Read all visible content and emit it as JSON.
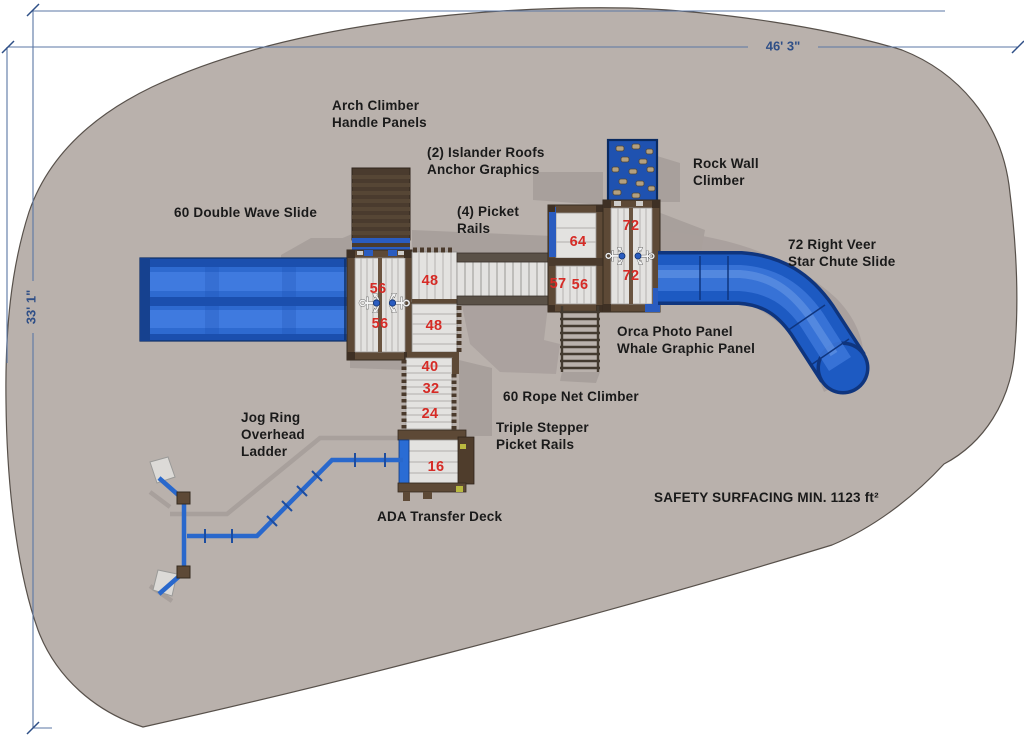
{
  "drawing": {
    "title_area": "playground plan view",
    "dimensions": {
      "width_label": "46' 3\"",
      "height_label": "33' 1\""
    },
    "labels": {
      "arch_climber": "Arch Climber\nHandle Panels",
      "islander_roofs": "(2) Islander Roofs\nAnchor Graphics",
      "picket_rails": "(4) Picket\nRails",
      "double_wave_slide": "60 Double Wave Slide",
      "rock_wall_climber": "Rock Wall\nClimber",
      "right_veer_slide": "72 Right Veer\nStar Chute Slide",
      "orca_panel": "Orca Photo Panel\nWhale Graphic Panel",
      "rope_net_climber": "60 Rope Net Climber",
      "triple_stepper": "Triple Stepper\nPicket Rails",
      "jog_ring": "Jog Ring\nOverhead\nLadder",
      "ada_transfer_deck": "ADA Transfer Deck",
      "safety_surfacing": "SAFETY SURFACING MIN. 1123 ft²"
    },
    "deck_heights": [
      {
        "value": "56"
      },
      {
        "value": "56"
      },
      {
        "value": "48"
      },
      {
        "value": "48"
      },
      {
        "value": "40"
      },
      {
        "value": "32"
      },
      {
        "value": "24"
      },
      {
        "value": "16"
      },
      {
        "value": "64"
      },
      {
        "value": "57"
      },
      {
        "value": "56"
      },
      {
        "value": "72"
      },
      {
        "value": "72"
      }
    ],
    "icons": {
      "anchor": "⚓"
    },
    "colors": {
      "ground": "#b9b1ac",
      "shadow": "#a8a09c",
      "dimension_blue": "#2f4f87",
      "height_red": "#d62b26",
      "slide_blue": "#1d5ac2",
      "frame_brown": "#5d4936",
      "deck_plank": "#e3e2e0",
      "rock_wall_blue": "#1f52b0",
      "rock_tan": "#b3a07f",
      "jog_ring_blue": "#2968cc"
    }
  }
}
